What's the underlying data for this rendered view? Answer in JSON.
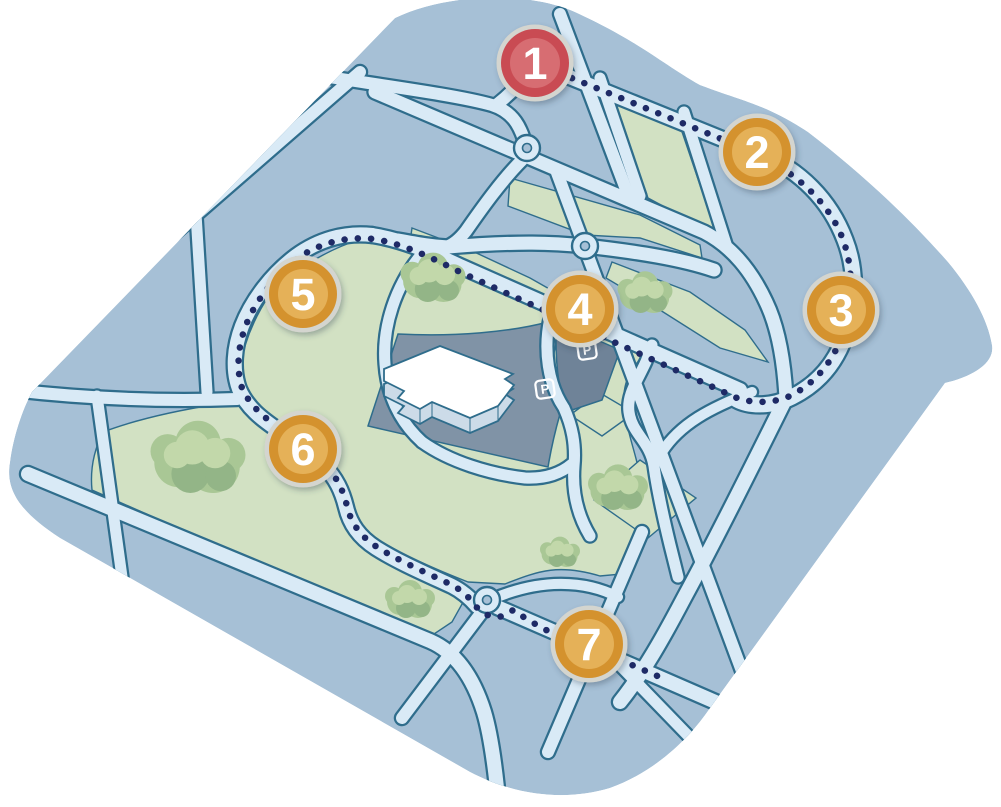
{
  "map": {
    "description": "isometric-campus-walking-route-map",
    "markers": [
      {
        "label": "1",
        "x": 535,
        "y": 63,
        "style": "start"
      },
      {
        "label": "2",
        "x": 757,
        "y": 152,
        "style": "stop"
      },
      {
        "label": "3",
        "x": 841,
        "y": 310,
        "style": "stop"
      },
      {
        "label": "4",
        "x": 580,
        "y": 309,
        "style": "stop"
      },
      {
        "label": "5",
        "x": 303,
        "y": 294,
        "style": "stop"
      },
      {
        "label": "6",
        "x": 303,
        "y": 449,
        "style": "stop"
      },
      {
        "label": "7",
        "x": 589,
        "y": 644,
        "style": "stop"
      }
    ],
    "parking_badges": [
      {
        "label": "P",
        "x": 545,
        "y": 389
      },
      {
        "label": "P",
        "x": 587,
        "y": 350
      }
    ],
    "colors": {
      "block_blue": "#a6c0d6",
      "road_light": "#d9eaf6",
      "road_edge": "#2f6d8c",
      "green": "#d2e1c3",
      "tree_base": "#a9c795",
      "tree_light": "#c2d8aa",
      "tree_shadow": "#93b587",
      "lot_gray": "#8093a6",
      "lot_gray_dark": "#6f8398",
      "route_dot": "#1e2a66",
      "marker_orange": "#d4922e",
      "marker_orange_light": "#e5b158",
      "marker_red": "#c94b52",
      "marker_red_light": "#d76d72",
      "marker_rim": "#d4d5cf",
      "building_roof": "#ffffff",
      "building_side": "#ccdbe8"
    }
  }
}
